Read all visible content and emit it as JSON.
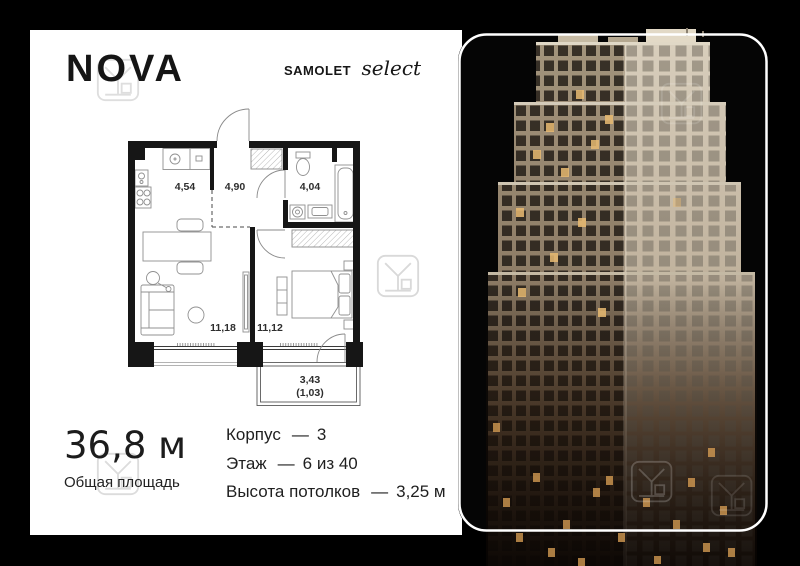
{
  "brand": {
    "logo": "NOVA",
    "developer": "samolet",
    "collection": "select"
  },
  "floor_plan": {
    "rooms": [
      {
        "name": "kitchen",
        "area": "4,54"
      },
      {
        "name": "hallway",
        "area": "4,90"
      },
      {
        "name": "bathroom",
        "area": "4,04"
      },
      {
        "name": "living-room",
        "area": "11,18"
      },
      {
        "name": "bedroom",
        "area": "11,12"
      }
    ],
    "balcony": {
      "area": "3,43",
      "reduced_area": "(1,03)"
    }
  },
  "summary": {
    "total_area": "36,8 м",
    "total_area_label": "Общая площадь"
  },
  "details": [
    {
      "label": "Корпус",
      "dash": "—",
      "value": "3"
    },
    {
      "label": "Этаж",
      "dash": "—",
      "value": "6 из 40"
    },
    {
      "label": "Высота потолков",
      "dash": "—",
      "value": "3,25 м"
    }
  ],
  "colors": {
    "background": "#000000",
    "page": "#ffffff",
    "text": "#1c1c1c",
    "building_beige": "#c0b29d",
    "lit_window": "#e2a95c"
  }
}
